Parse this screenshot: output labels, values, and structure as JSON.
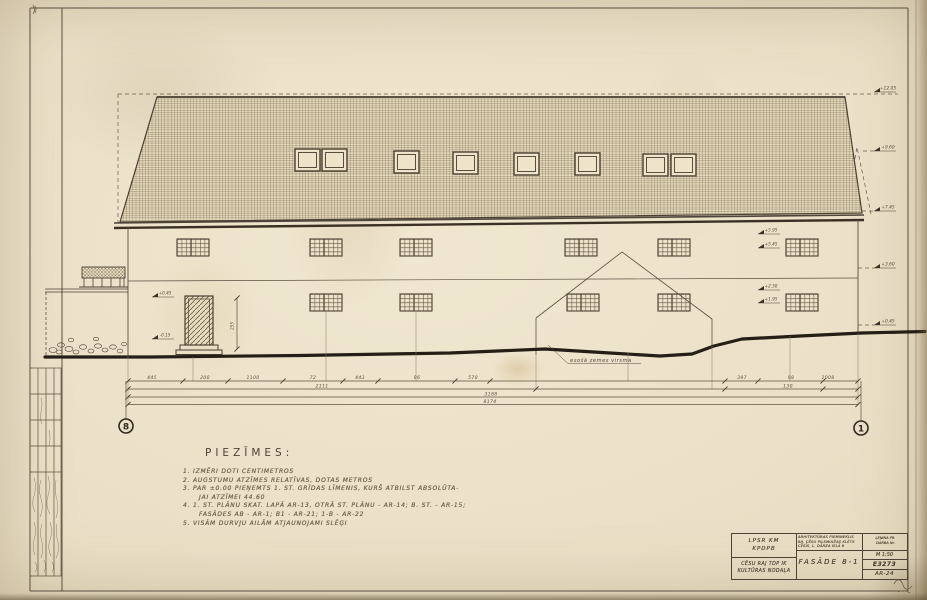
{
  "notes": {
    "title": "PIEZĪMES:",
    "lines": [
      "1. IZMĒRI DOTI CENTIMETROS",
      "2. AUGSTUMU ATZĪMES RELATĪVAS, DOTAS METROS",
      "3. PAR ±0.00 PIEŅEMTS 1. ST. GRĪDAS LĪMENIS, KURŠ ATBILST ABSOLŪTA-",
      "JAI ATZĪMEI 44.60",
      "4. 1. ST. PLĀNU SKAT. LAPĀ AR-13, OTRĀ ST. PLĀNU - AR-14; B. ST. - AR-15;",
      "FASĀDES AB - AR-1; B1 - AR-21; 1-B - AR-22",
      "5. VISĀM DURVJU AILĀM ATJAUNOJAMI SLĒĢI"
    ]
  },
  "labels": {
    "ground_surface": "esošā zemes virsma"
  },
  "grid": {
    "left": "8",
    "right": "1"
  },
  "levels": {
    "right": [
      "+12.05",
      "+9.60",
      "+7.45",
      "+3.60",
      "+0.45"
    ],
    "left_wall": [
      "+0.45",
      "-0.15"
    ],
    "win_upper": [
      "+5.95",
      "+5.45"
    ],
    "win_lower": [
      "+2.50",
      "+1.95"
    ],
    "door": "255"
  },
  "dimensions": {
    "row1": [
      "445",
      "200",
      "1100",
      "72",
      "443",
      "96",
      "570",
      "397",
      "98",
      "1008"
    ],
    "row2": [
      "2111",
      "130"
    ],
    "row3": "3188",
    "row4": "8174"
  },
  "title_block": {
    "org_top_1": "LPSR KM",
    "org_top_2": "KPDPB",
    "org_bottom_1": "CĒSU RAJ TDP IK",
    "org_bottom_2": "KULTŪRAS NODAĻA",
    "project_1": "ARHITEKTŪRAS PIEMINEKLIS",
    "project_2": "BIJ. CĒSU PILSMUIŽAS KLĒTS",
    "project_3": "CĒSĪS, L. DĀRZA IELĀ 6",
    "side_1": "ĻEŅINA PR.",
    "side_2": "DARBA Nr.",
    "drawing_title": "FASĀDE 8-1",
    "scale": "M 1:50",
    "order_no": "E3273",
    "sheet_no": "AR-24"
  }
}
